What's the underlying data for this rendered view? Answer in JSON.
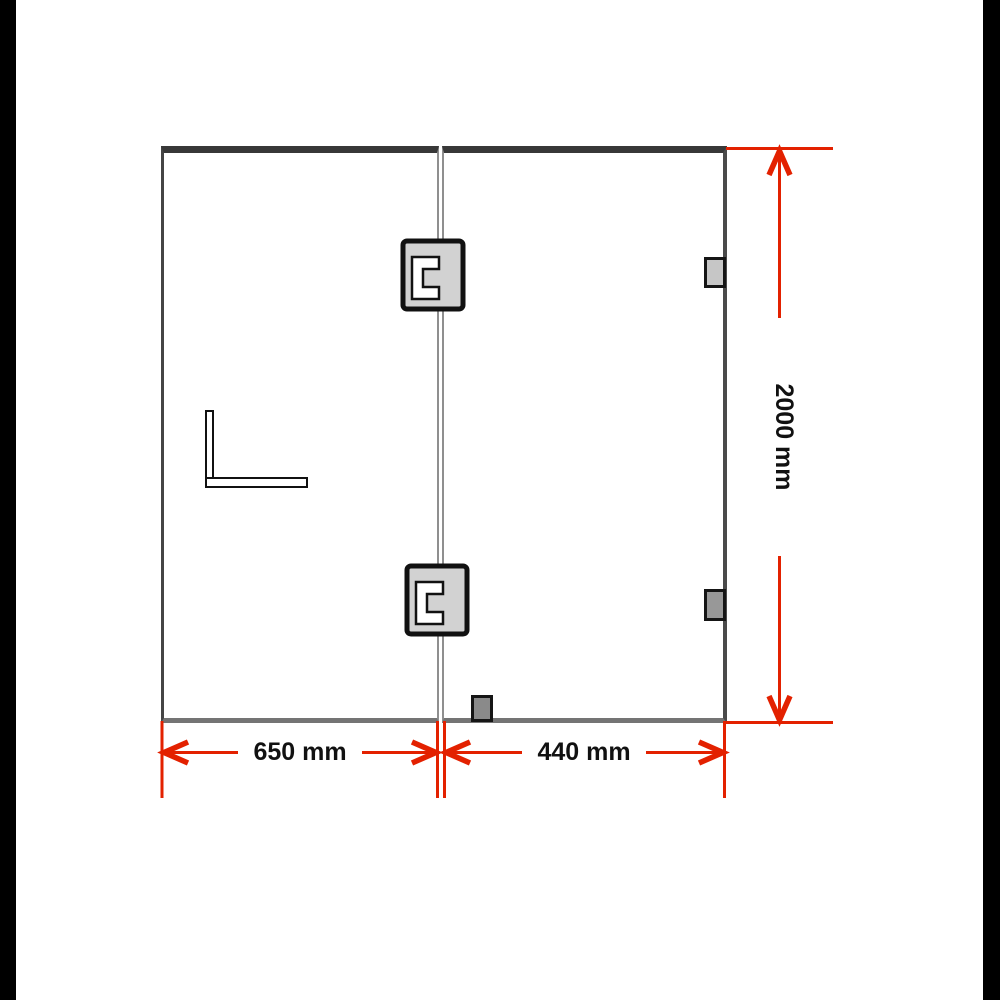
{
  "diagram": {
    "labels": {
      "left_panel_width": "650 mm",
      "door_panel_width": "440 mm",
      "total_height": "2000 mm"
    },
    "colors": {
      "dimension_red": "#e32100",
      "frame_top_bar": "#383838",
      "frame_side": "#4a4a4a",
      "frame_bottom": "#747474",
      "glass_seam": "#8f8f8f",
      "hinge_fill": "#d2d2d2",
      "bracket_top_fill": "#c6c6c6",
      "bracket_bottom_fill": "#989898",
      "floor_bracket_fill": "#8a8a8a",
      "photo_border": "#000000",
      "background": "#ffffff",
      "label_text": "#111111"
    },
    "components": [
      "left-glass-panel",
      "door-glass-panel",
      "glass-hinge-top",
      "glass-hinge-bottom",
      "wall-bracket-top",
      "wall-bracket-bottom",
      "floor-bracket",
      "l-handle"
    ]
  }
}
